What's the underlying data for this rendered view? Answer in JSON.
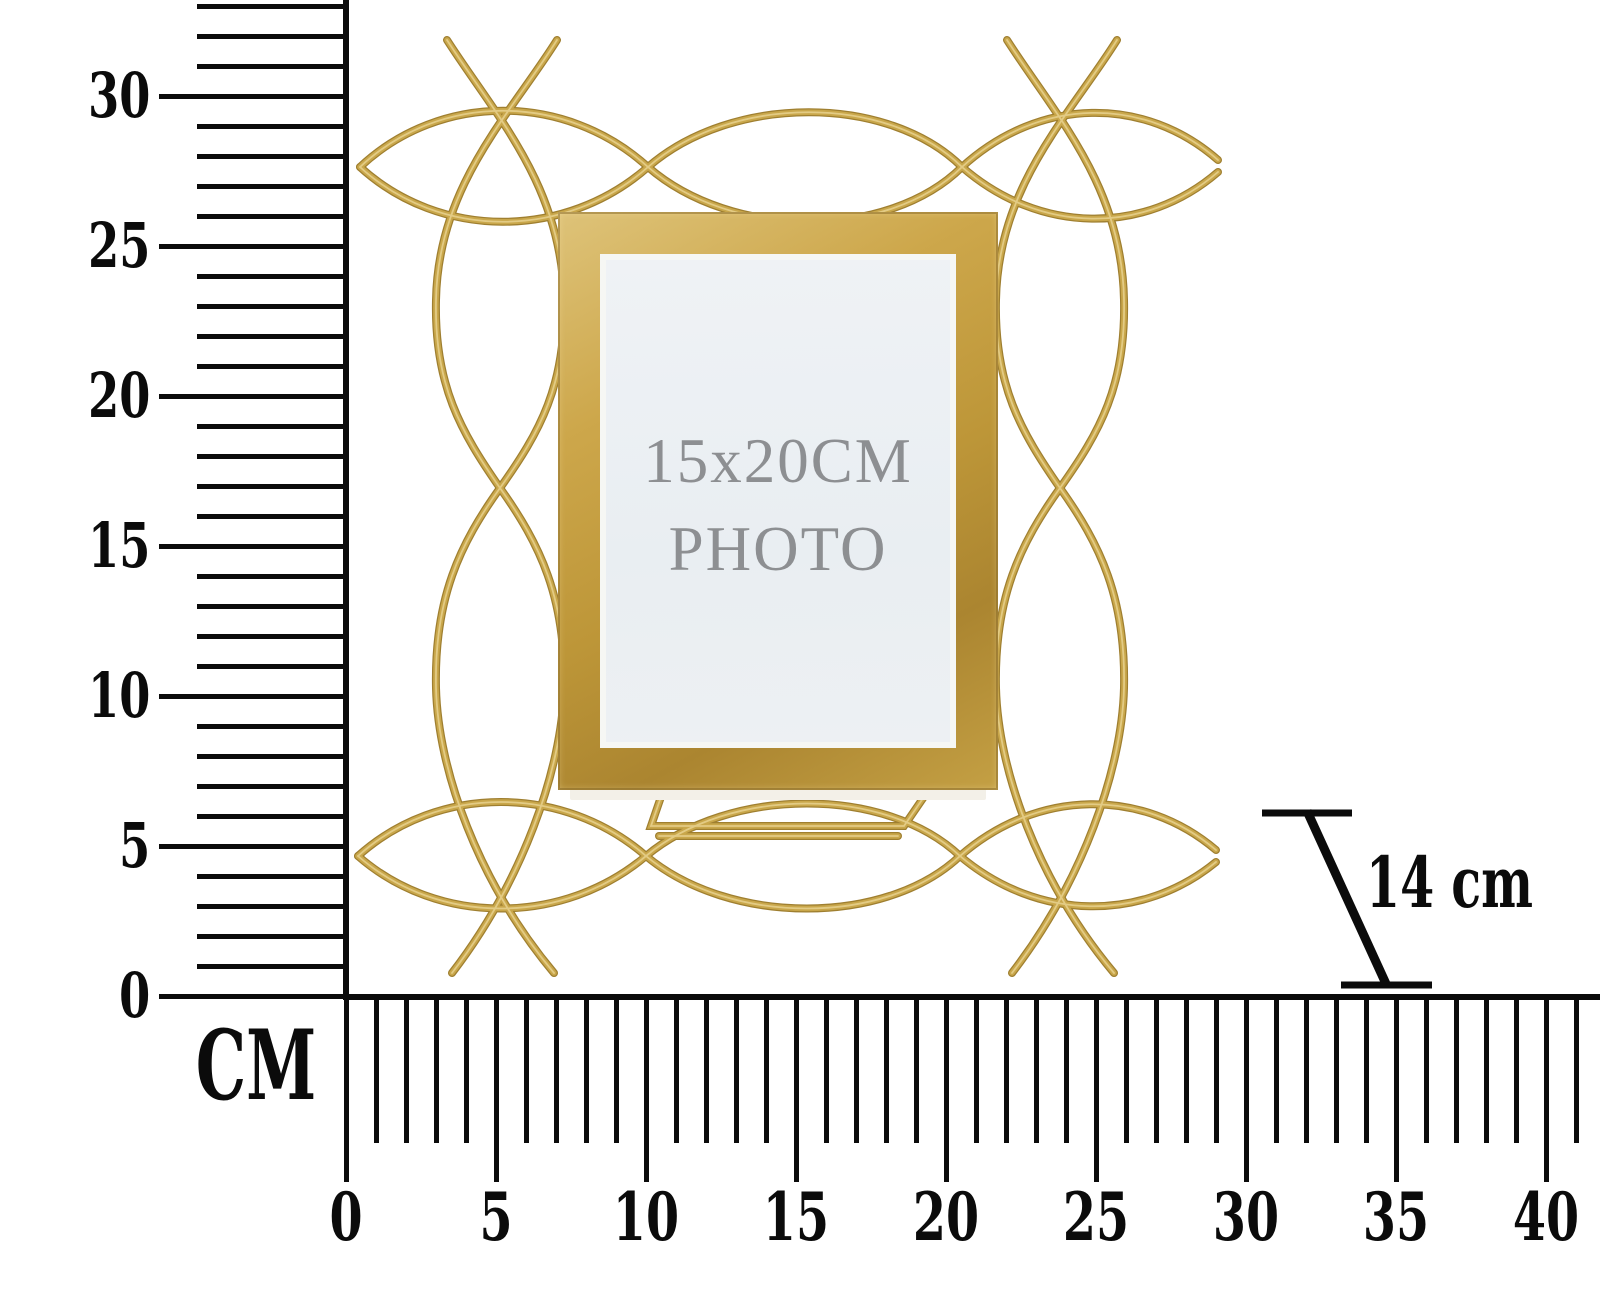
{
  "diagram": {
    "unit_label": "CM",
    "vertical_ruler": {
      "min_cm": 0,
      "max_tick_cm": 33,
      "labeled_values": [
        0,
        5,
        10,
        15,
        20,
        25,
        30
      ]
    },
    "horizontal_ruler": {
      "min_cm": 0,
      "max_tick_cm": 41,
      "labeled_values": [
        0,
        5,
        10,
        15,
        20,
        25,
        30,
        35,
        40
      ]
    },
    "depth_annotation": "14 cm"
  },
  "product": {
    "placeholder_line1": "15x20CM",
    "placeholder_line2": "PHOTO"
  },
  "colors": {
    "ink": "#0b0b0b",
    "wire_gold_dark": "#9f7f30",
    "wire_gold_mid": "#c9a74b",
    "wire_gold_highlight": "#e8d28f",
    "frame_gold_light": "#dec379",
    "frame_gold_mid": "#cda74b",
    "frame_gold_dark": "#ab8530",
    "photo_background": "#e9eef2",
    "placeholder_text": "#8d8f92",
    "mat_white": "#f6f7f4",
    "backing_edge": "#f3f0e8"
  }
}
